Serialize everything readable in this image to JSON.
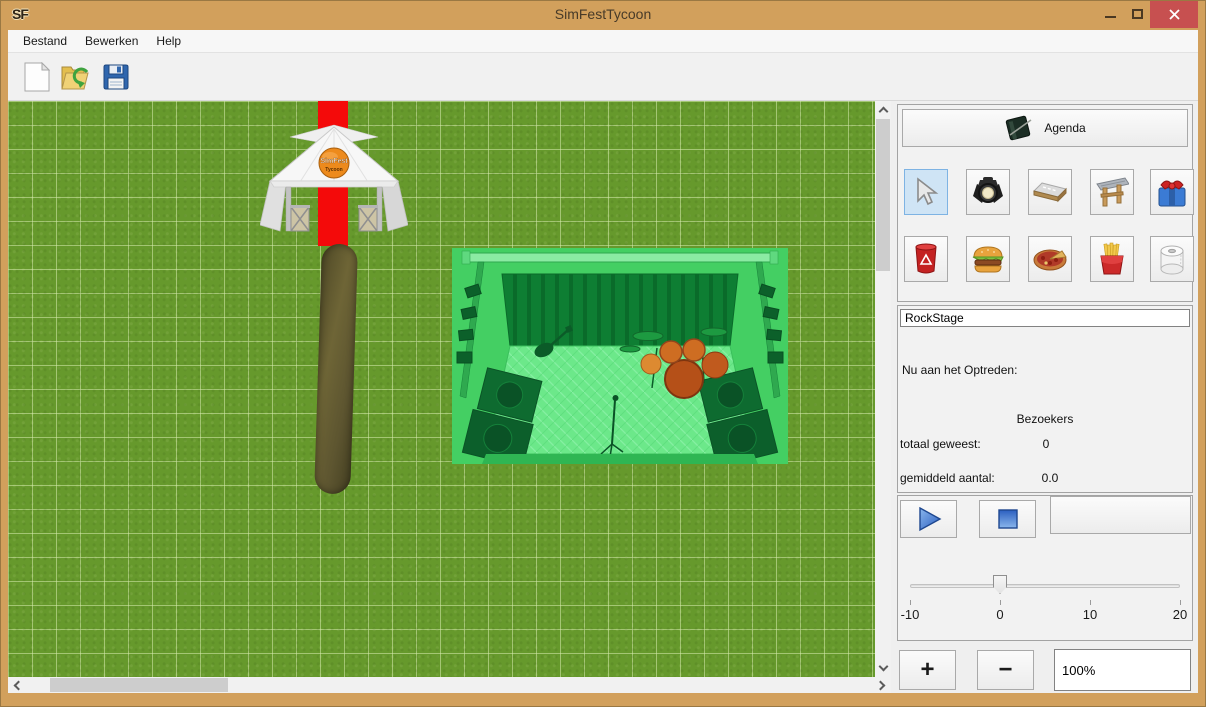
{
  "window": {
    "icon": "SF",
    "title": "SimFestTycoon",
    "controls": [
      "minimize",
      "maximize",
      "close"
    ]
  },
  "menu": {
    "items": [
      {
        "label": "Bestand"
      },
      {
        "label": "Bewerken"
      },
      {
        "label": "Help"
      }
    ]
  },
  "toolbar": {
    "buttons": [
      {
        "name": "new-file"
      },
      {
        "name": "open-file"
      },
      {
        "name": "save-file"
      }
    ]
  },
  "canvas": {
    "objects": [
      {
        "name": "entrance-tent"
      },
      {
        "name": "red-carpet"
      },
      {
        "name": "dirt-path"
      },
      {
        "name": "stage",
        "selected": true
      }
    ],
    "tent_logo_line1": "SimFest",
    "tent_logo_line2": "Tycoon"
  },
  "panel": {
    "agenda_button": {
      "label": "Agenda",
      "icon": "agenda-book-icon"
    },
    "tool_rows": [
      [
        {
          "name": "select-cursor",
          "selected": true
        },
        {
          "name": "spotlight"
        },
        {
          "name": "road-tile"
        },
        {
          "name": "entrance-gate"
        },
        {
          "name": "gift"
        }
      ],
      [
        {
          "name": "trash-bin"
        },
        {
          "name": "burger-stand"
        },
        {
          "name": "pizza-stand"
        },
        {
          "name": "fries-stand"
        },
        {
          "name": "toilet"
        }
      ]
    ],
    "stage_name_value": "RockStage",
    "now_performing_label": "Nu aan het Optreden:",
    "visitors_header": "Bezoekers",
    "total_label": "totaal geweest:",
    "total_value": "0",
    "average_label": "gemiddeld aantal:",
    "average_value": "0.0",
    "slider": {
      "min": -10,
      "max": 20,
      "value": 0,
      "tick_labels": [
        "-10",
        "0",
        "10",
        "20"
      ]
    },
    "zoom": {
      "in_label": "+",
      "out_label": "−",
      "value": "100%"
    }
  },
  "colors": {
    "titlebar": "#D2A05C",
    "close_button": "#C75050",
    "grass": "#66992C",
    "grid_line": "#D7EBAF",
    "selection_green": "#44CF63",
    "carpet_red": "#F40A0A"
  }
}
